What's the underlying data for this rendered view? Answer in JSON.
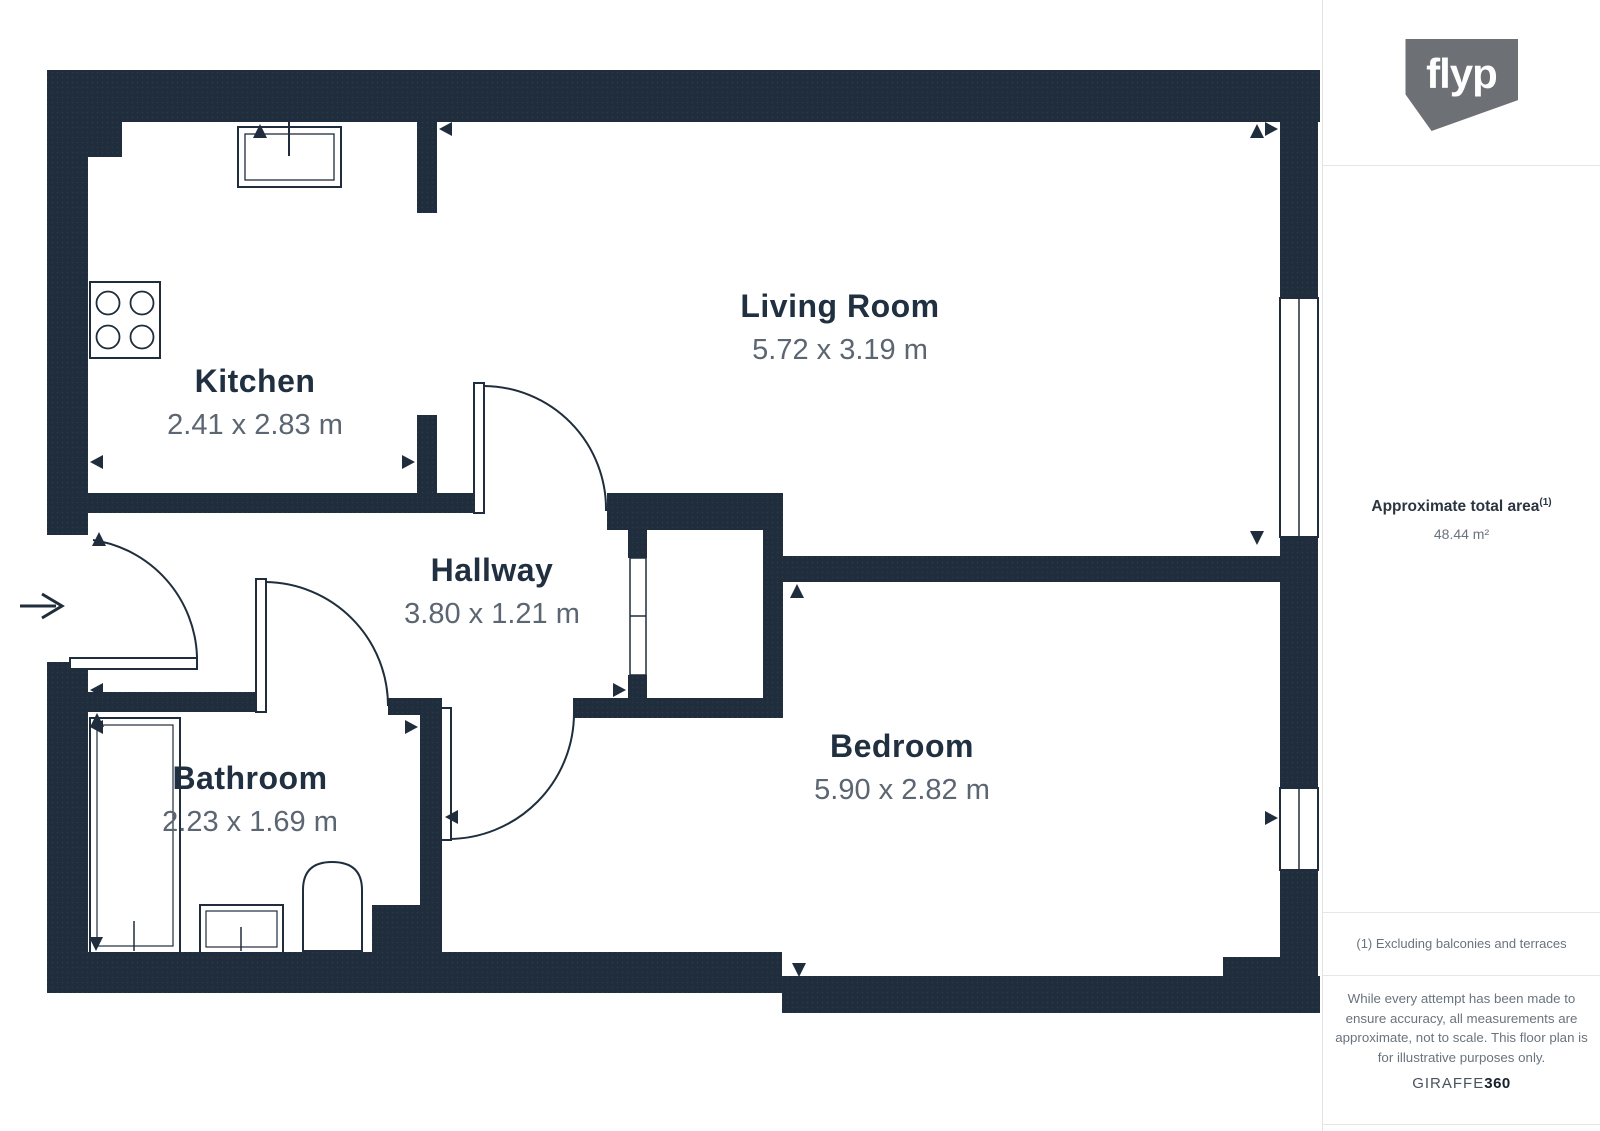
{
  "page": {
    "background": "#ffffff"
  },
  "floorplan": {
    "rooms": [
      {
        "name": "Kitchen",
        "dimensions": "2.41 x 2.83 m"
      },
      {
        "name": "Living Room",
        "dimensions": "5.72 x 3.19 m"
      },
      {
        "name": "Hallway",
        "dimensions": "3.80 x 1.21 m"
      },
      {
        "name": "Bathroom",
        "dimensions": "2.23 x 1.69 m"
      },
      {
        "name": "Bedroom",
        "dimensions": "5.90 x 2.82 m"
      }
    ],
    "colors": {
      "wall": "#1f2d3c",
      "room_name_text": "#203040",
      "dimensions_text": "#5b6672"
    }
  },
  "sidebar": {
    "logo_text": "flyp",
    "logo_color": "#6d7175",
    "area_label": "Approximate total area",
    "area_footnote_marker": "(1)",
    "area_value": "48.44 m²",
    "footnote": "(1) Excluding balconies and terraces",
    "disclaimer": "While every attempt has been made to ensure accuracy, all measurements are approximate, not to scale. This floor plan is for illustrative purposes only.",
    "brand_name": "GIRAFFE",
    "brand_suffix": "360"
  }
}
